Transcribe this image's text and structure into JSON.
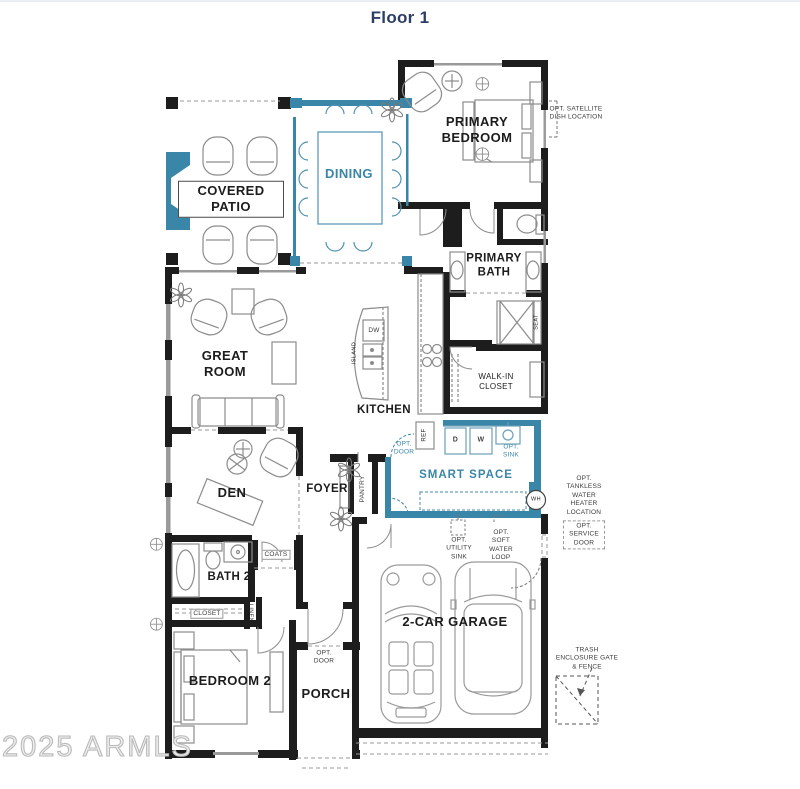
{
  "page": {
    "title": "Floor 1",
    "watermark": "2025 ARMLS"
  },
  "colors": {
    "accent_teal": "#3a86a9",
    "wall_black": "#1d1d1d",
    "title_navy": "#2d3e66"
  },
  "rooms": {
    "covered_patio": "COVERED PATIO",
    "dining": "DINING",
    "primary_bedroom": "PRIMARY BEDROOM",
    "primary_bath": "PRIMARY BATH",
    "great_room": "GREAT ROOM",
    "kitchen": "KITCHEN",
    "walk_in_closet": "WALK-IN CLOSET",
    "smart_space": "SMART SPACE",
    "den": "DEN",
    "foyer": "FOYER",
    "bath_2": "BATH 2",
    "bedroom_2": "BEDROOM 2",
    "porch": "PORCH",
    "garage": "2-CAR GARAGE"
  },
  "fixtures": {
    "island": "ISLAND",
    "dishwasher": "DW",
    "fridge": "REF",
    "dryer": "D",
    "washer": "W",
    "water_heater": "WH",
    "seat": "SEAT",
    "pantry": "PANTRY",
    "coats": "COATS",
    "closet": "CLOSET",
    "linen": "LINEN"
  },
  "annotations": {
    "satellite": "OPT. SATELLITE DISH LOCATION",
    "tankless": "OPT. TANKLESS WATER HEATER LOCATION",
    "service_door": "OPT. SERVICE DOOR",
    "utility_sink": "OPT. UTILITY SINK",
    "soft_water": "OPT. SOFT WATER LOOP",
    "trash": "TRASH ENCLOSURE GATE & FENCE",
    "opt_door_kitchen": "OPT. DOOR",
    "opt_door_porch": "OPT. DOOR",
    "opt_sink": "OPT. SINK"
  }
}
